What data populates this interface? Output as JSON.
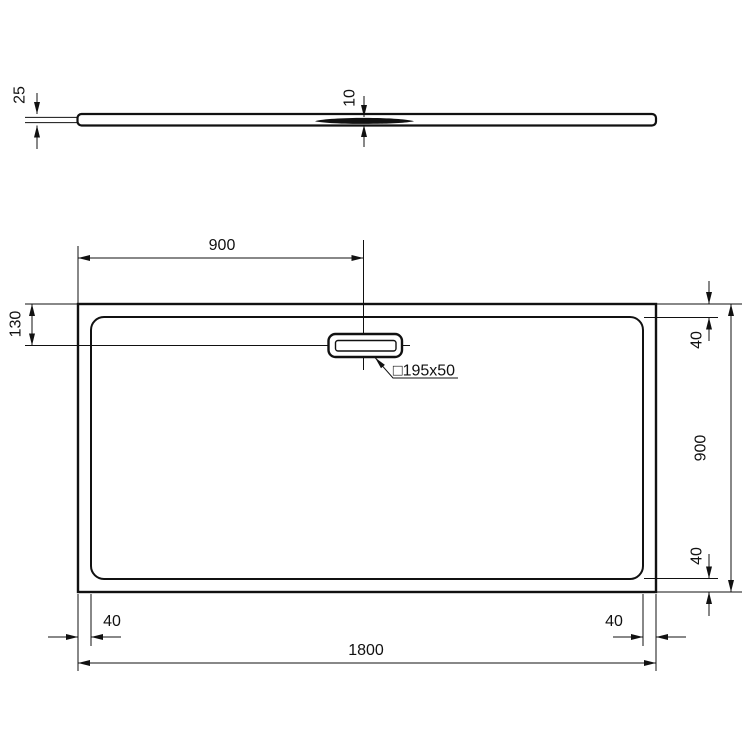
{
  "page": {
    "background": "#ffffff",
    "line_color": "#111111"
  },
  "dimensions": {
    "profile_height": "25",
    "recess_depth": "10",
    "drain_center_from_left": "900",
    "drain_center_from_top": "130",
    "rim_top_right": "40",
    "overall_depth": "900",
    "rim_bottom_right_side": "40",
    "rim_bottom_left": "40",
    "rim_bottom_right": "40",
    "overall_width": "1800",
    "drain_size": "□195x50"
  }
}
